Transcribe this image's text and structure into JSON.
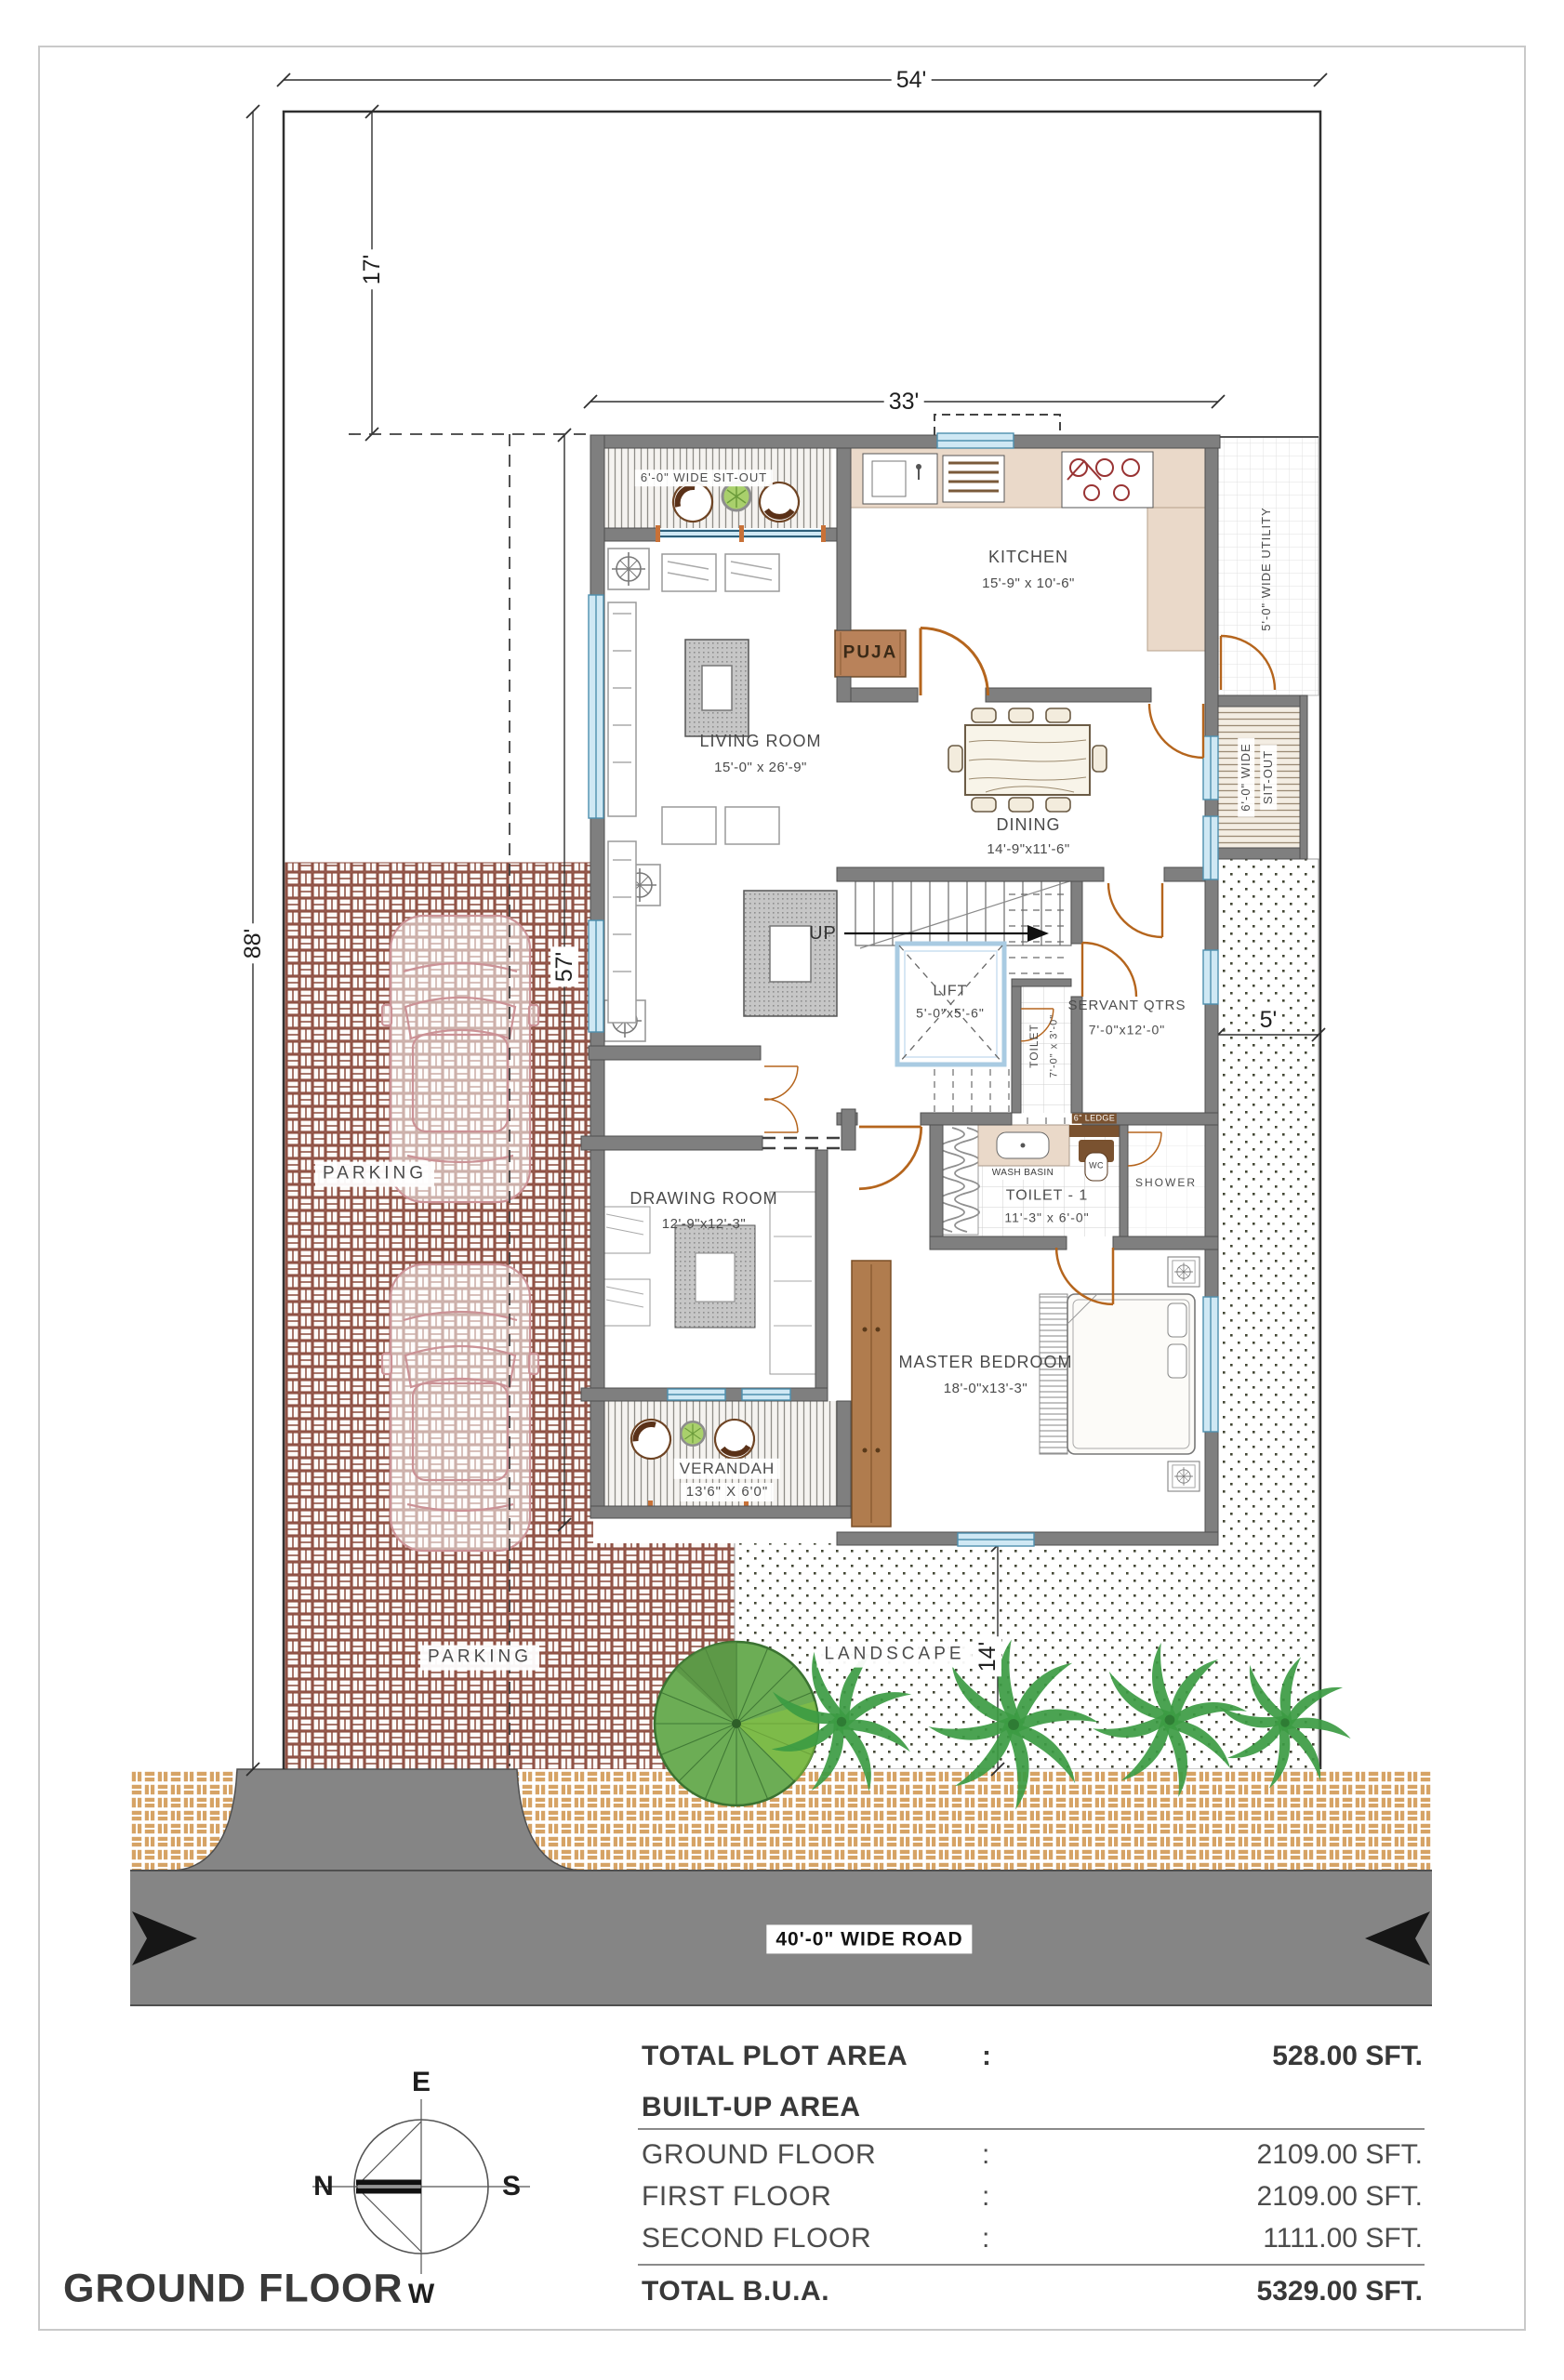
{
  "dimensions": {
    "top_width": "54'",
    "left_height": "88'",
    "setback_top": "17'",
    "building_width": "33'",
    "building_height": "57'",
    "east_side": "5'",
    "south_setback": "14'"
  },
  "rooms": {
    "sitout_north": "6'-0\" WIDE SIT-OUT",
    "kitchen": {
      "name": "KITCHEN",
      "size": "15'-9\" x 10'-6\""
    },
    "utility": "5'-0\" WIDE UTILITY",
    "puja": "PUJA",
    "living": {
      "name": "LIVING ROOM",
      "size": "15'-0\" x 26'-9\""
    },
    "dining": {
      "name": "DINING",
      "size": "14'-9\"x11'-6\""
    },
    "sitout_east": {
      "l1": "6'-0\" WIDE",
      "l2": "SIT-OUT"
    },
    "lift": {
      "name": "LIFT",
      "size": "5'-0\"x5'-6\""
    },
    "toilet_small": {
      "name": "TOILET",
      "size": "7'-0\" x 3'-0\""
    },
    "servant": {
      "name": "SERVANT QTRS",
      "size": "7'-0\"x12'-0\""
    },
    "toilet1": {
      "name": "TOILET - 1",
      "size": "11'-3\" x 6'-0\""
    },
    "master": {
      "name": "MASTER BEDROOM",
      "size": "18'-0\"x13'-3\""
    },
    "drawing": {
      "name": "DRAWING ROOM",
      "size": "12'-9\"x12'-3\""
    },
    "verandah": {
      "name": "VERANDAH",
      "size": "13'6\" X 6'0\""
    }
  },
  "fixtures": {
    "up": "UP",
    "wash_basin": "WASH BASIN",
    "ledge": "6\" LEDGE",
    "wc": "WC",
    "shower": "SHOWER"
  },
  "outdoor": {
    "parking_upper": "PARKING",
    "parking_lower": "PARKING",
    "landscape": "LANDSCAPE",
    "road": "40'-0\" WIDE ROAD"
  },
  "compass": {
    "east": "E",
    "south": "S",
    "west": "W",
    "north": "N"
  },
  "title": "GROUND FLOOR",
  "area_table": {
    "colon": ":",
    "plot_label": "TOTAL PLOT AREA",
    "plot_value": "528.00 SFT.",
    "bua_header": "BUILT-UP AREA",
    "rows": [
      {
        "label": "GROUND FLOOR",
        "value": "2109.00 SFT."
      },
      {
        "label": "FIRST FLOOR",
        "value": "2109.00 SFT."
      },
      {
        "label": "SECOND FLOOR",
        "value": "1111.00 SFT."
      }
    ],
    "total_label": "TOTAL B.U.A.",
    "total_value": "5329.00 SFT."
  },
  "colors": {
    "wall": "#7f7f7f",
    "door": "#b5651d",
    "window": "#cfe8f4",
    "parking_brick": "#8a4a3c",
    "footpath": "#d6a365",
    "road": "#858585",
    "landscape_green": "#3c9b43",
    "lift_border": "#a9cbe2",
    "counter_beige": "#ead9c9",
    "puja_brown": "#b9825a"
  }
}
